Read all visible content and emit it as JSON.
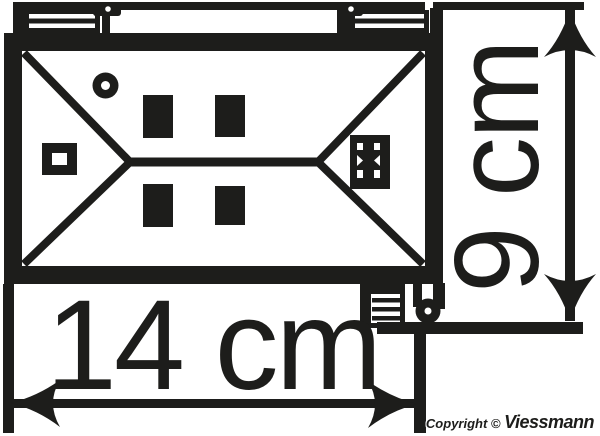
{
  "diagram": {
    "description": "Top view plan of model building roof with dimension arrows",
    "ink_color": "#1d1d1b",
    "background_color": "#ffffff"
  },
  "dimensions": {
    "width_label": "14 cm",
    "height_label": "9 cm"
  },
  "footer": {
    "copyright_prefix": "Copyright © ",
    "brand": "Viessmann"
  }
}
